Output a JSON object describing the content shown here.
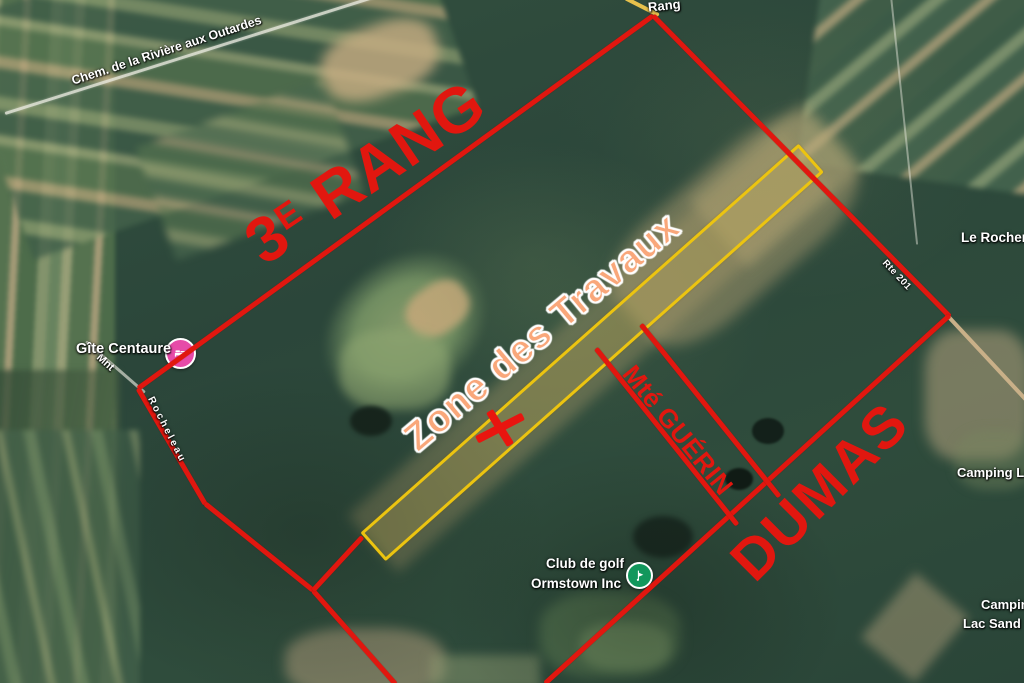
{
  "annotations": {
    "rang3_base": "3",
    "rang3_sup": "E",
    "rang3_rest": "RANG",
    "dumas": "DUMAS",
    "guerin": "Mté GUÉRIN",
    "zone": "Zone des Travaux"
  },
  "roads": {
    "outardes": "Chem. de la Rivière aux Outardes",
    "rang": "Rang",
    "rte201": "Rte 201",
    "mnt": "Mnt",
    "rocheleau": "Rocheleau"
  },
  "places": {
    "gite": "Gîte Centaure",
    "rocher": "Le Rocher",
    "camping_right": "Camping La",
    "camping_bottom_line1": "Camping",
    "camping_bottom_line2": "Lac Sand",
    "golf_line1": "Club de golf",
    "golf_line2": "Ormstown Inc"
  },
  "icons": {
    "lodging_pin": "bed-lodging-pin-icon",
    "golf_pin": "golf-flag-pin-icon",
    "work_marker": "red-x-marker-icon"
  },
  "colors": {
    "annotation_red": "#e1170f",
    "zone_outline_yellow": "#ecc410",
    "zone_text_orange": "#f9a77a",
    "map_label_white": "#ffffff",
    "lodging_pin_pink": "#e64ba8",
    "golf_pin_green": "#12975c",
    "route_continuation_tan": "#c9b088"
  }
}
